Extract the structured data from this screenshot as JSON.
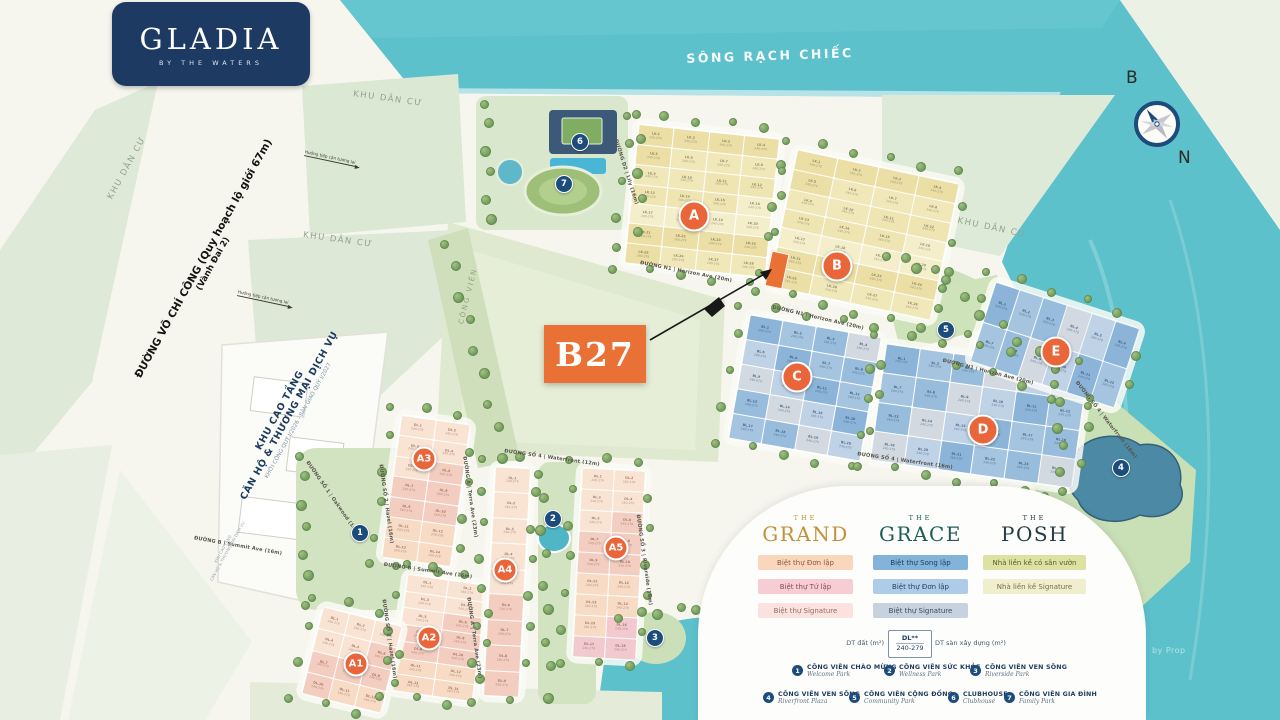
{
  "logo": {
    "name": "GLADIA",
    "tagline": "BY THE WATERS"
  },
  "river": {
    "label": "SÔNG RẠCH CHIẾC"
  },
  "compass": {
    "top": "B",
    "bottom": "N"
  },
  "watermark": "by Prop",
  "highlight": {
    "label": "B27"
  },
  "main_road": {
    "line1": "ĐƯỜNG VÕ CHÍ CÔNG (Quy hoạch lộ giới 67m)",
    "line2": "(Vành Đai 2)"
  },
  "tower_block": {
    "line1": "KHU CAO TẦNG",
    "line2": "CĂN HỘ & THƯƠNG MẠI DỊCH VỤ",
    "line3": "KHỞI CÔNG QUÝ I/2026 - BÀN GIAO QUÝ I/2027"
  },
  "area_labels": {
    "khu_dan_cu": "KHU DÂN CƯ",
    "cong_vien": "CÔNG VIÊN",
    "future_access": "Hướng tiếp cận tương lai"
  },
  "streets": [
    {
      "label": "ĐƯỜNG N1 | Horizon Ave (20m)"
    },
    {
      "label": "ĐƯỜNG N1 | Horizon Ave (20m)"
    },
    {
      "label": "ĐƯỜNG N1 | Horizon Ave (20m)"
    },
    {
      "label": "ĐƯỜNG SỐ 4 | Waterfront (16m)"
    },
    {
      "label": "ĐƯỜNG SỐ 4 | Waterfront (16m)"
    },
    {
      "label": "ĐƯỜNG SỐ 4 | Waterfront (12m)"
    },
    {
      "label": "ĐƯỜNG B | Summit Ave (16m)"
    },
    {
      "label": "ĐƯỜNG B | Summit Ave (16m)"
    },
    {
      "label": "ĐƯỜNG A | Terra Ave (23m)"
    },
    {
      "label": "ĐƯỜNG A | Terra Ave (23m)"
    },
    {
      "label": "ĐƯỜNG D2 | Lily (16m)"
    },
    {
      "label": "ĐƯỜNG SỐ 1 | Oakwood (16m)"
    },
    {
      "label": "ĐƯỜNG SỐ 2 | Hazel (16m)"
    },
    {
      "label": "ĐƯỜNG SỐ 2 | Hazel (16m)"
    },
    {
      "label": "ĐƯỜNG SỐ 3 | Riverside (16m)"
    }
  ],
  "zones": [
    {
      "id": "A",
      "code": "LK",
      "range": "240-279",
      "family": "cream"
    },
    {
      "id": "B",
      "code": "LK",
      "range": "240-279",
      "family": "cream"
    },
    {
      "id": "C",
      "code": "BL",
      "range": "240-279",
      "family": "blue"
    },
    {
      "id": "D",
      "code": "BL",
      "range": "240-279",
      "family": "blue"
    },
    {
      "id": "E",
      "code": "BL",
      "range": "240-279",
      "family": "blue"
    },
    {
      "id": "A3",
      "code": "DL",
      "range": "240-279",
      "family": "peach"
    },
    {
      "id": "A2",
      "code": "DL",
      "range": "240-279",
      "family": "peach"
    },
    {
      "id": "A1",
      "code": "DL",
      "range": "240-279",
      "family": "peach"
    },
    {
      "id": "A4",
      "code": "DL",
      "range": "240-279",
      "family": "peach"
    },
    {
      "id": "A5",
      "code": "DL",
      "range": "240-279",
      "family": "peach"
    }
  ],
  "park_markers": [
    {
      "n": "1"
    },
    {
      "n": "2"
    },
    {
      "n": "3"
    },
    {
      "n": "4"
    },
    {
      "n": "5"
    },
    {
      "n": "6"
    },
    {
      "n": "7"
    }
  ],
  "legend": {
    "brands": [
      {
        "the": "THE",
        "name": "GRAND",
        "color": "#c2913a",
        "chips": [
          {
            "label": "Biệt thự Đơn lập",
            "bg": "#f9d6bc",
            "fg": "#8d5a3d"
          },
          {
            "label": "Biệt thự Tứ lập",
            "bg": "#f5cdd3",
            "fg": "#8d4a5a"
          },
          {
            "label": "Biệt thự Signature",
            "bg": "#fbe2df",
            "fg": "#9a6a64"
          }
        ]
      },
      {
        "the": "THE",
        "name": "GRACE",
        "color": "#1d5c58",
        "chips": [
          {
            "label": "Biệt thự Song lập",
            "bg": "#84b3da",
            "fg": "#173a5e"
          },
          {
            "label": "Biệt thự Đơn lập",
            "bg": "#aecbe7",
            "fg": "#1d4468"
          },
          {
            "label": "Biệt thự Signature",
            "bg": "#c8d2de",
            "fg": "#3a4a60"
          }
        ]
      },
      {
        "the": "THE",
        "name": "POSH",
        "color": "#233c46",
        "chips": [
          {
            "label": "Nhà liền kề có sân vườn",
            "bg": "#dde2a2",
            "fg": "#55602a"
          },
          {
            "label": "Nhà liền kề Signature",
            "bg": "#f0eecd",
            "fg": "#70704a"
          }
        ]
      }
    ],
    "size_key": {
      "code": "DL**",
      "range": "240-279",
      "left": "DT đất (m²)",
      "right": "DT sàn xây dựng (m²)"
    },
    "parks": [
      {
        "n": "1",
        "vi": "CÔNG VIÊN CHÀO MỪNG",
        "en": "Welcome Park"
      },
      {
        "n": "2",
        "vi": "CÔNG VIÊN SỨC KHỎE",
        "en": "Wellness Park"
      },
      {
        "n": "3",
        "vi": "CÔNG VIÊN VEN SÔNG",
        "en": "Riverside Park"
      },
      {
        "n": "4",
        "vi": "CÔNG VIÊN VEN SÔNG",
        "en": "Riverfront Plaza"
      },
      {
        "n": "5",
        "vi": "CÔNG VIÊN CỘNG ĐỒNG",
        "en": "Community Park"
      },
      {
        "n": "6",
        "vi": "CLUBHOUSE",
        "en": "Clubhouse"
      },
      {
        "n": "7",
        "vi": "CÔNG VIÊN GIA ĐÌNH",
        "en": "Family Park"
      }
    ]
  },
  "colors": {
    "accent_orange": "#e97136",
    "marker_blue": "#1c4c7c",
    "water": "#5cc1cb",
    "navy": "#1d3a63"
  }
}
